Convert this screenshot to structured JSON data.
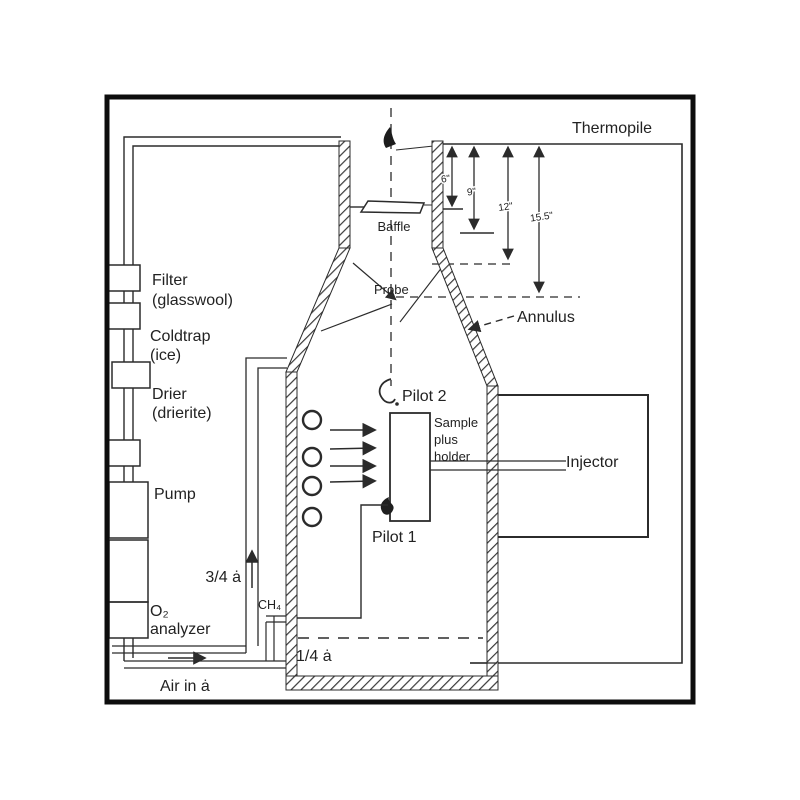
{
  "labels": {
    "thermopile": "Thermopile",
    "baffle": "Baffle",
    "probe": "Probe",
    "annulus": "Annulus",
    "pilot2": "Pilot 2",
    "pilot1": "Pilot 1",
    "sample_line1": "Sample",
    "sample_line2": "plus",
    "sample_line3": "holder",
    "injector": "Injector",
    "ch4": "CH₄",
    "pipe_three_quarter": "3/4 ȧ",
    "pipe_quarter": "1/4 ȧ",
    "air_in": "Air in ȧ"
  },
  "train_components": [
    {
      "line1": "Filter",
      "line2": "(glasswool)"
    },
    {
      "line1": "Coldtrap",
      "line2": "(ice)"
    },
    {
      "line1": "Drier",
      "line2": "(drierite)"
    },
    {
      "line1": "Pump",
      "line2": ""
    },
    {
      "line1": "O₂",
      "line2": "analyzer"
    }
  ],
  "dimensions": {
    "d1": "6\"",
    "d2": "9\"",
    "d3": "12\"",
    "d4": "15.5\""
  },
  "colors": {
    "ink": "#2b2b2b",
    "paper": "#ffffff",
    "frame": "#0d0d0d"
  }
}
